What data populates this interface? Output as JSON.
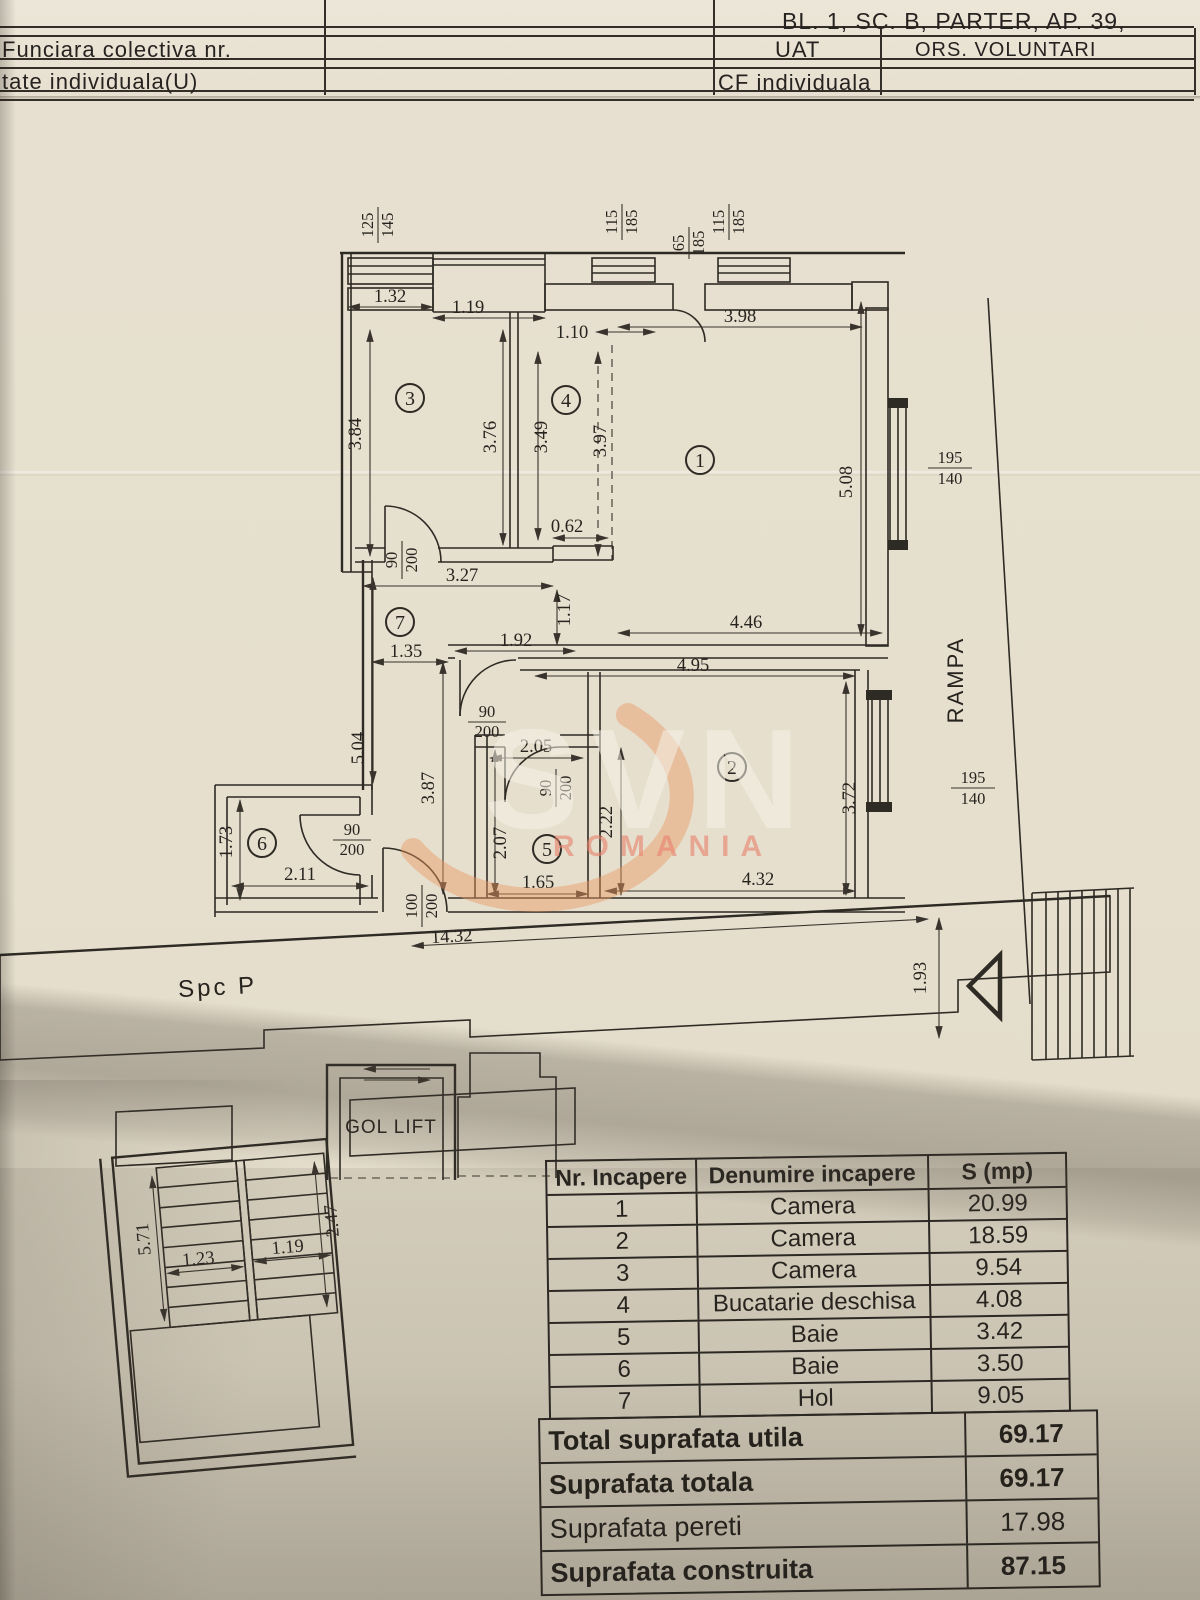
{
  "header": {
    "address": "BL. 1, SC. B, PARTER, AP. 39,",
    "row1": {
      "c1": "Funciara colectiva nr.",
      "c3": "UAT",
      "c4": "ORS. VOLUNTARI"
    },
    "row2": {
      "c1": "tate individuala(U)",
      "c3": "CF individuala"
    }
  },
  "plan": {
    "labels": {
      "corridor": "Spc P",
      "lift": "GOL LIFT",
      "ramp": "RAMPA"
    },
    "rooms": {
      "r1": "1",
      "r2": "2",
      "r3": "3",
      "r4": "4",
      "r5": "5",
      "r6": "6",
      "r7": "7"
    },
    "openings": [
      {
        "n": "125",
        "d": "145"
      },
      {
        "n": "115",
        "d": "185"
      },
      {
        "n": "65",
        "d": "185"
      },
      {
        "n": "115",
        "d": "185"
      },
      {
        "n": "195",
        "d": "140"
      },
      {
        "n": "195",
        "d": "140"
      }
    ],
    "doors": [
      {
        "n": "90",
        "d": "200"
      },
      {
        "n": "90",
        "d": "200"
      },
      {
        "n": "90",
        "d": "200"
      },
      {
        "n": "90",
        "d": "200"
      },
      {
        "n": "100",
        "d": "200"
      }
    ],
    "dims": {
      "d_132": "1.32",
      "d_119a": "1.19",
      "d_110": "1.10",
      "d_398": "3.98",
      "d_384": "3.84",
      "d_376": "3.76",
      "d_349": "3.49",
      "d_397": "3.97",
      "d_062": "0.62",
      "d_508": "5.08",
      "d_327": "3.27",
      "d_117": "1.17",
      "d_192": "1.92",
      "d_446": "4.46",
      "d_135": "1.35",
      "d_495": "4.95",
      "d_504": "5.04",
      "d_205": "2.05",
      "d_387": "3.87",
      "d_207": "2.07",
      "d_222": "2.22",
      "d_372": "3.72",
      "d_165": "1.65",
      "d_432": "4.32",
      "d_173": "1.73",
      "d_211": "2.11",
      "d_1432": "14.32",
      "d_193": "1.93",
      "d_123": "1.23",
      "d_119b": "1.19",
      "d_571": "5.71",
      "d_247": "2.47"
    }
  },
  "watermark": {
    "brand": "SVN",
    "country": "ROMANIA"
  },
  "area_table": {
    "headers": [
      "Nr. Incapere",
      "Denumire incapere",
      "S (mp)"
    ],
    "rows": [
      [
        "1",
        "Camera",
        "20.99"
      ],
      [
        "2",
        "Camera",
        "18.59"
      ],
      [
        "3",
        "Camera",
        "9.54"
      ],
      [
        "4",
        "Bucatarie deschisa",
        "4.08"
      ],
      [
        "5",
        "Baie",
        "3.42"
      ],
      [
        "6",
        "Baie",
        "3.50"
      ],
      [
        "7",
        "Hol",
        "9.05"
      ]
    ],
    "totals": [
      [
        "Total suprafata utila",
        "69.17"
      ],
      [
        "Suprafata totala",
        "69.17"
      ],
      [
        "Suprafata pereti",
        "17.98"
      ],
      [
        "Suprafata construita",
        "87.15"
      ]
    ]
  }
}
